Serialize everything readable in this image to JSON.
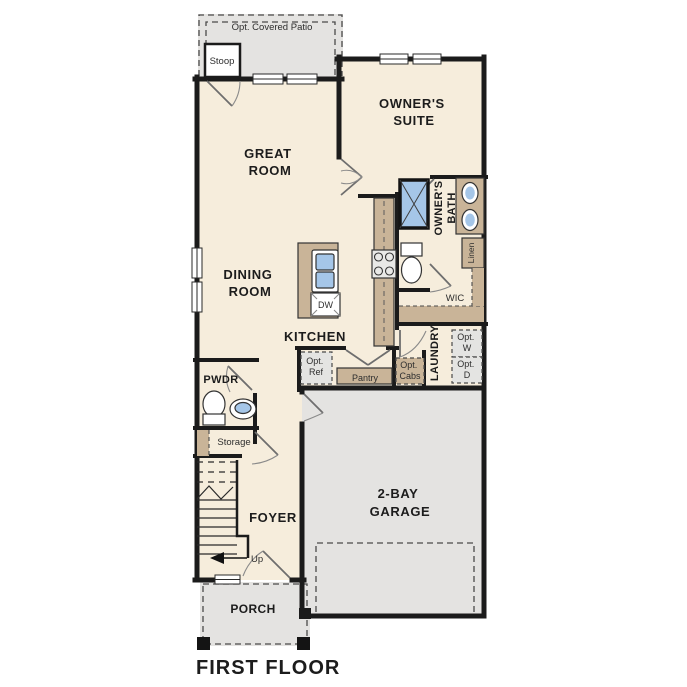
{
  "title": "FIRST FLOOR",
  "colors": {
    "interior_floor": "#f6eddc",
    "outdoor_concrete": "#e4e3e1",
    "walls": "#1b1b1b",
    "cabinetry_tan": "#c9b498",
    "plumbing_blue": "#a5c6e8",
    "appliance_gray": "#e4e4e2",
    "label_text": "#1c1c1c"
  },
  "rooms": {
    "patio": {
      "label": "Opt. Covered Patio"
    },
    "stoop": {
      "label": "Stoop"
    },
    "owners_suite": {
      "line1": "OWNER'S",
      "line2": "SUITE"
    },
    "great_room": {
      "line1": "GREAT",
      "line2": "ROOM"
    },
    "dining_room": {
      "line1": "DINING",
      "line2": "ROOM"
    },
    "kitchen": {
      "label": "KITCHEN"
    },
    "owners_bath": {
      "line1": "OWNER'S",
      "line2": "BATH"
    },
    "linen": {
      "label": "Linen"
    },
    "wic": {
      "label": "WIC"
    },
    "laundry": {
      "label": "LAUNDRY"
    },
    "pwdr": {
      "label": "PWDR"
    },
    "storage": {
      "label": "Storage"
    },
    "foyer": {
      "label": "FOYER"
    },
    "garage": {
      "line1": "2-BAY",
      "line2": "GARAGE"
    },
    "porch": {
      "label": "PORCH"
    },
    "pantry": {
      "label": "Pantry"
    }
  },
  "fixtures": {
    "dishwasher": "DW",
    "opt_ref": {
      "line1": "Opt.",
      "line2": "Ref"
    },
    "opt_cabs": {
      "line1": "Opt.",
      "line2": "Cabs"
    },
    "opt_washer": {
      "line1": "Opt.",
      "line2": "W"
    },
    "opt_dryer": {
      "line1": "Opt.",
      "line2": "D"
    },
    "stairs_up": "Up"
  }
}
